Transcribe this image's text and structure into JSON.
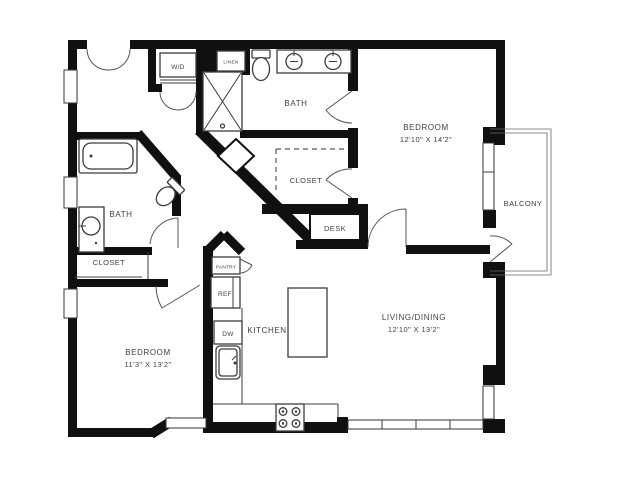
{
  "page": {
    "colors": {
      "background": "#ffffff",
      "wall_color": "#101010",
      "line_color": "#3c3c3c",
      "text_color": "#414141"
    }
  },
  "floor_plan": {
    "type": "apartment-floor-plan",
    "rooms": {
      "bedroom_1": {
        "label": "BEDROOM",
        "dims": "12'10\" X 14'2\""
      },
      "living_dining": {
        "label": "LIVING/DINING",
        "dims": "12'10\" X 13'2\""
      },
      "bedroom_2": {
        "label": "BEDROOM",
        "dims": "11'3\" X 13'2\""
      },
      "bath_top": {
        "label": "BATH"
      },
      "bath_left": {
        "label": "BATH"
      },
      "kitchen": {
        "label": "KITCHEN"
      },
      "balcony": {
        "label": "BALCONY"
      },
      "closet_1": {
        "label": "CLOSET"
      },
      "closet_2": {
        "label": "CLOSET"
      },
      "desk_nook": {
        "label": "DESK"
      }
    },
    "fixtures": {
      "washer_dryer": "W/D",
      "linen": "LINEN",
      "pantry": "PANTRY",
      "refrigerator": "REF",
      "dishwasher": "DW"
    }
  }
}
